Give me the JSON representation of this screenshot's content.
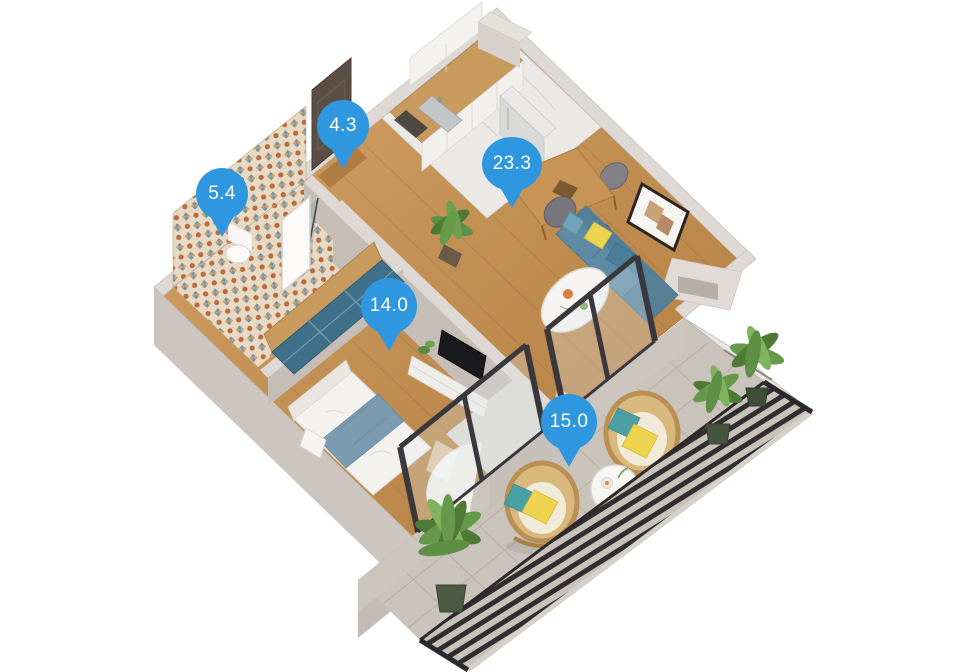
{
  "scene": {
    "type": "apartment-3d-floor-plan",
    "background": "#FFFFFF"
  },
  "pins": [
    {
      "room": "hallway",
      "label": "4.3",
      "icon": "map-pin-icon"
    },
    {
      "room": "bathroom",
      "label": "5.4",
      "icon": "map-pin-icon"
    },
    {
      "room": "living-kitchen",
      "label": "23.3",
      "icon": "map-pin-icon"
    },
    {
      "room": "bedroom",
      "label": "14.0",
      "icon": "map-pin-icon"
    },
    {
      "room": "balcony",
      "label": "15.0",
      "icon": "map-pin-icon"
    }
  ],
  "colors": {
    "pin_blue": "#2E97DF",
    "pin_text": "#FFFFFF",
    "wood_floor": "#C9955A",
    "wall_top": "#DDD8D3",
    "wall_face": "#CDC5BF",
    "marble": "#EBE9E5",
    "sofa_teal": "#5E8BA3",
    "accent_yellow": "#EED34F",
    "wardrobe_teal": "#3F7089",
    "blanket_blue": "#7B9CB0",
    "balcony_floor": "#C9C3BC",
    "railing_dark": "#353135",
    "plant_green": "#66994A",
    "rattan": "#D9B87E",
    "tile_orange": "#C96F3F",
    "tile_blue": "#7292B5"
  }
}
